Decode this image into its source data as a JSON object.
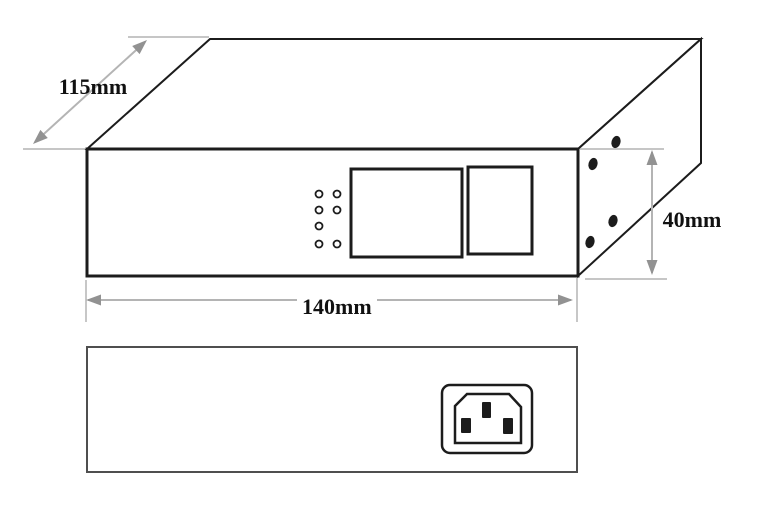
{
  "dimensions": {
    "depth_label": "115mm",
    "width_label": "140mm",
    "height_label": "40mm"
  },
  "icons": {
    "power_inlet": "iec-c14-power-inlet-icon"
  },
  "counts": {
    "front_panel_led_holes": 7,
    "side_panel_screw_holes": 4
  },
  "colors": {
    "outline": "#1c1c1c",
    "dimension_line": "#b4b4b4",
    "dimension_arrow": "#929292",
    "rear_outline": "#4f4f4f",
    "background": "#ffffff"
  }
}
